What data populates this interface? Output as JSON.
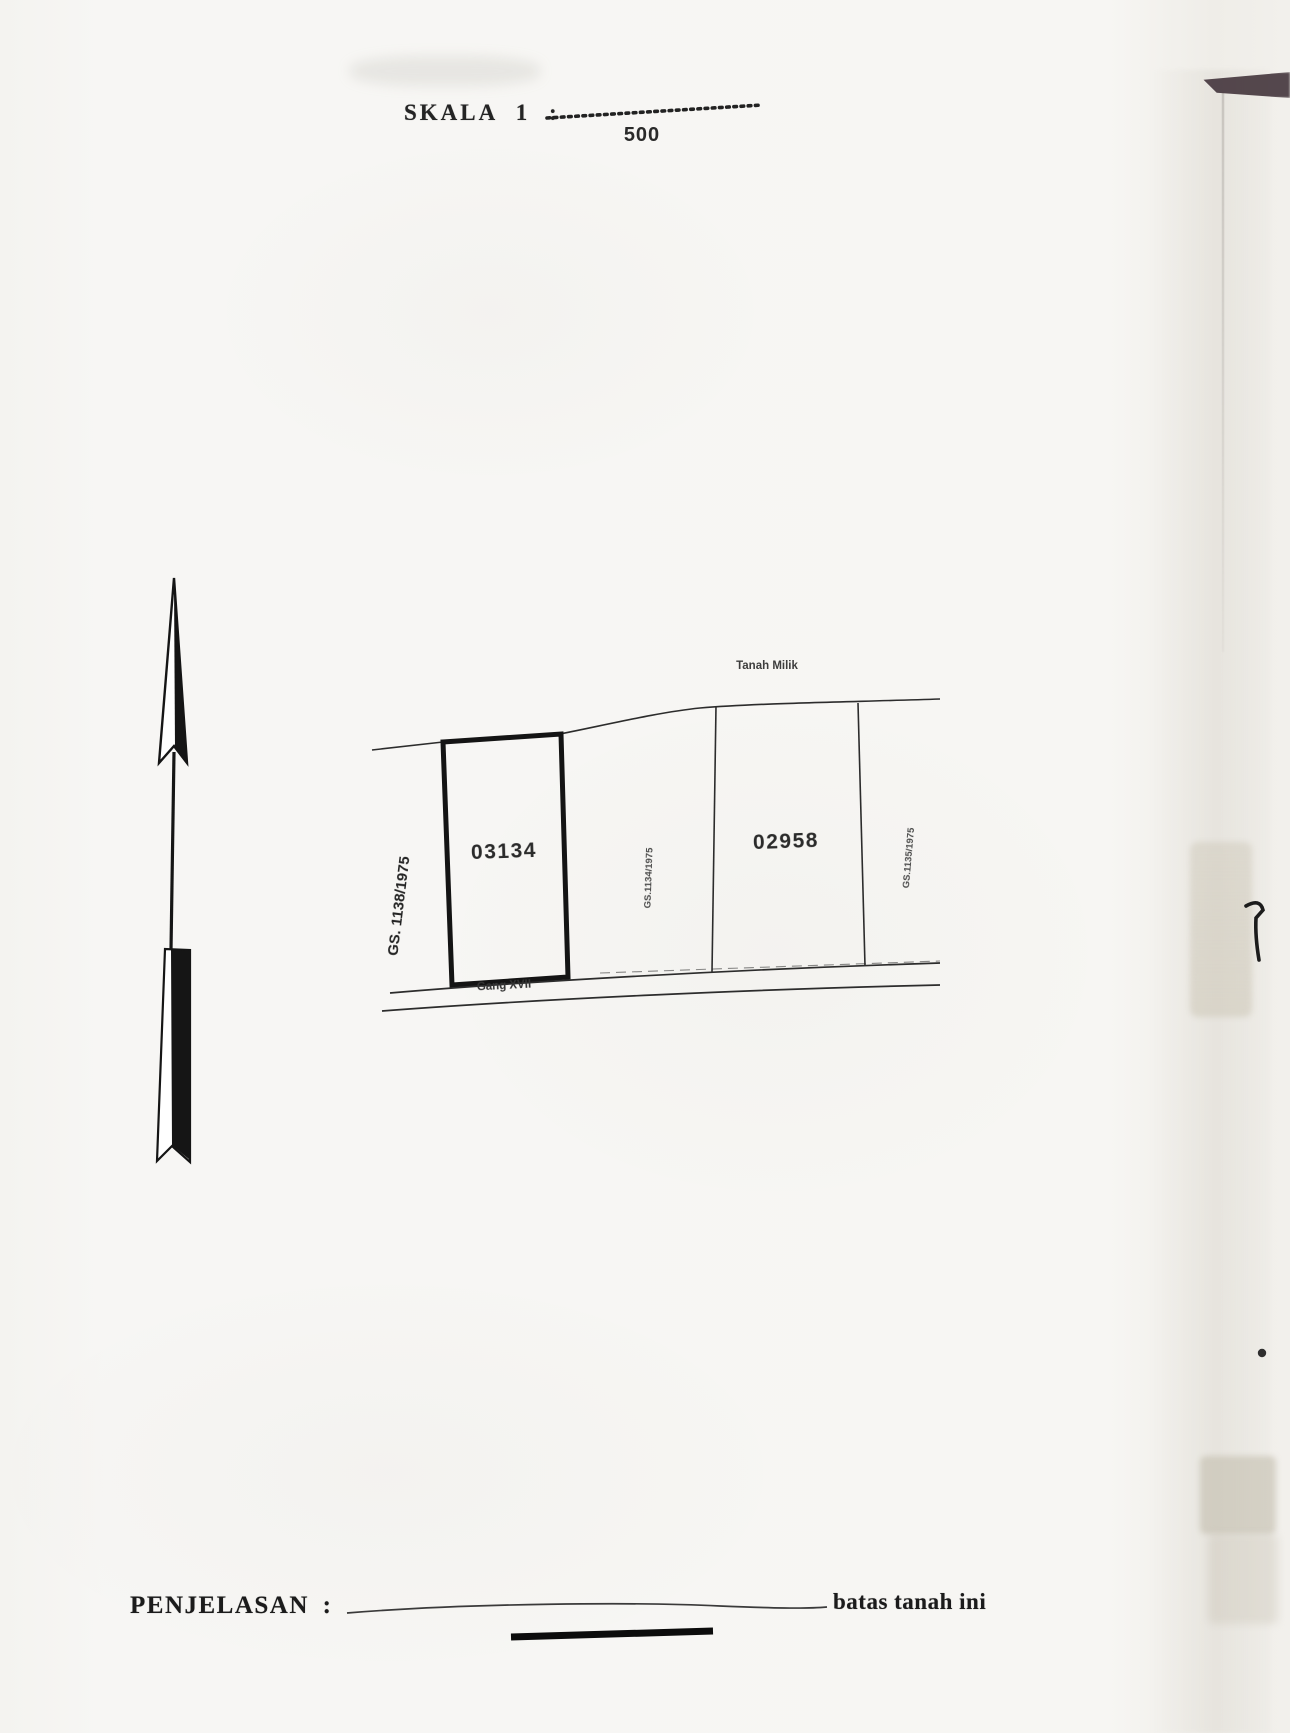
{
  "document": {
    "scale": {
      "label": "SKALA 1 :",
      "value": "500"
    },
    "map": {
      "land_label": "Tanah Milik",
      "road_label": "Gang XVII",
      "parcel_left_id": "03134",
      "parcel_right_id": "02958",
      "gs_left": "GS. 1138/1975",
      "gs_middle": "GS.1134/1975",
      "gs_right": "GS.1135/1975"
    },
    "legend": {
      "label": "PENJELASAN :",
      "boundary_text": "batas tanah ini"
    },
    "icons": {
      "north_arrow": "north-arrow"
    },
    "colors": {
      "ink": "#1f1f1f",
      "paper": "#f6f5f2",
      "corner_mark": "#47393f"
    }
  }
}
